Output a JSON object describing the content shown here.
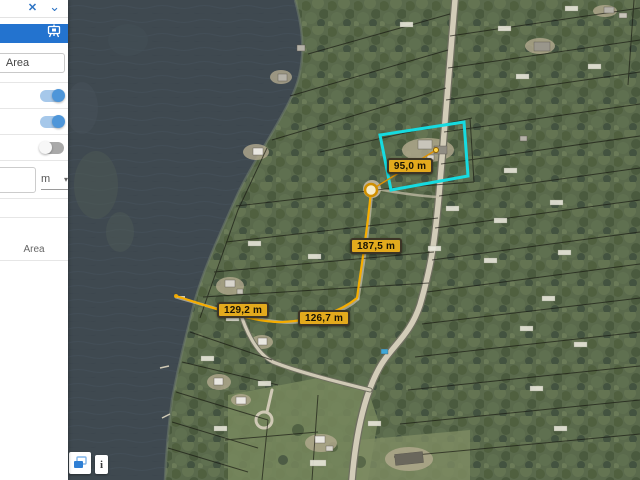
{
  "sidebar": {
    "close_label": "✕",
    "collapse_label": "⌄",
    "mode_button_label": "Area",
    "toggles": [
      {
        "on": true
      },
      {
        "on": true
      },
      {
        "on": false
      }
    ],
    "unit_input_value": "",
    "unit_select_value": "m",
    "unit_select_arrow": "▾",
    "result_section_label": "Area"
  },
  "map": {
    "controls": {
      "info_label": "i"
    },
    "measurements": {
      "unit": "m",
      "segments": [
        {
          "label": "129,2 m"
        },
        {
          "label": "126,7 m"
        },
        {
          "label": "187,5 m"
        },
        {
          "label": "95,0 m"
        }
      ]
    },
    "colors": {
      "accent_blue": "#2373cf",
      "toggle_on": "#4e96d9",
      "measure_line": "#f5ad00",
      "measure_label_bg": "#e3aa1d",
      "parcel_highlight": "#16dbe0",
      "water": "#3f4950",
      "forest": "#5a6a4c",
      "road": "#d2ccb8"
    }
  }
}
